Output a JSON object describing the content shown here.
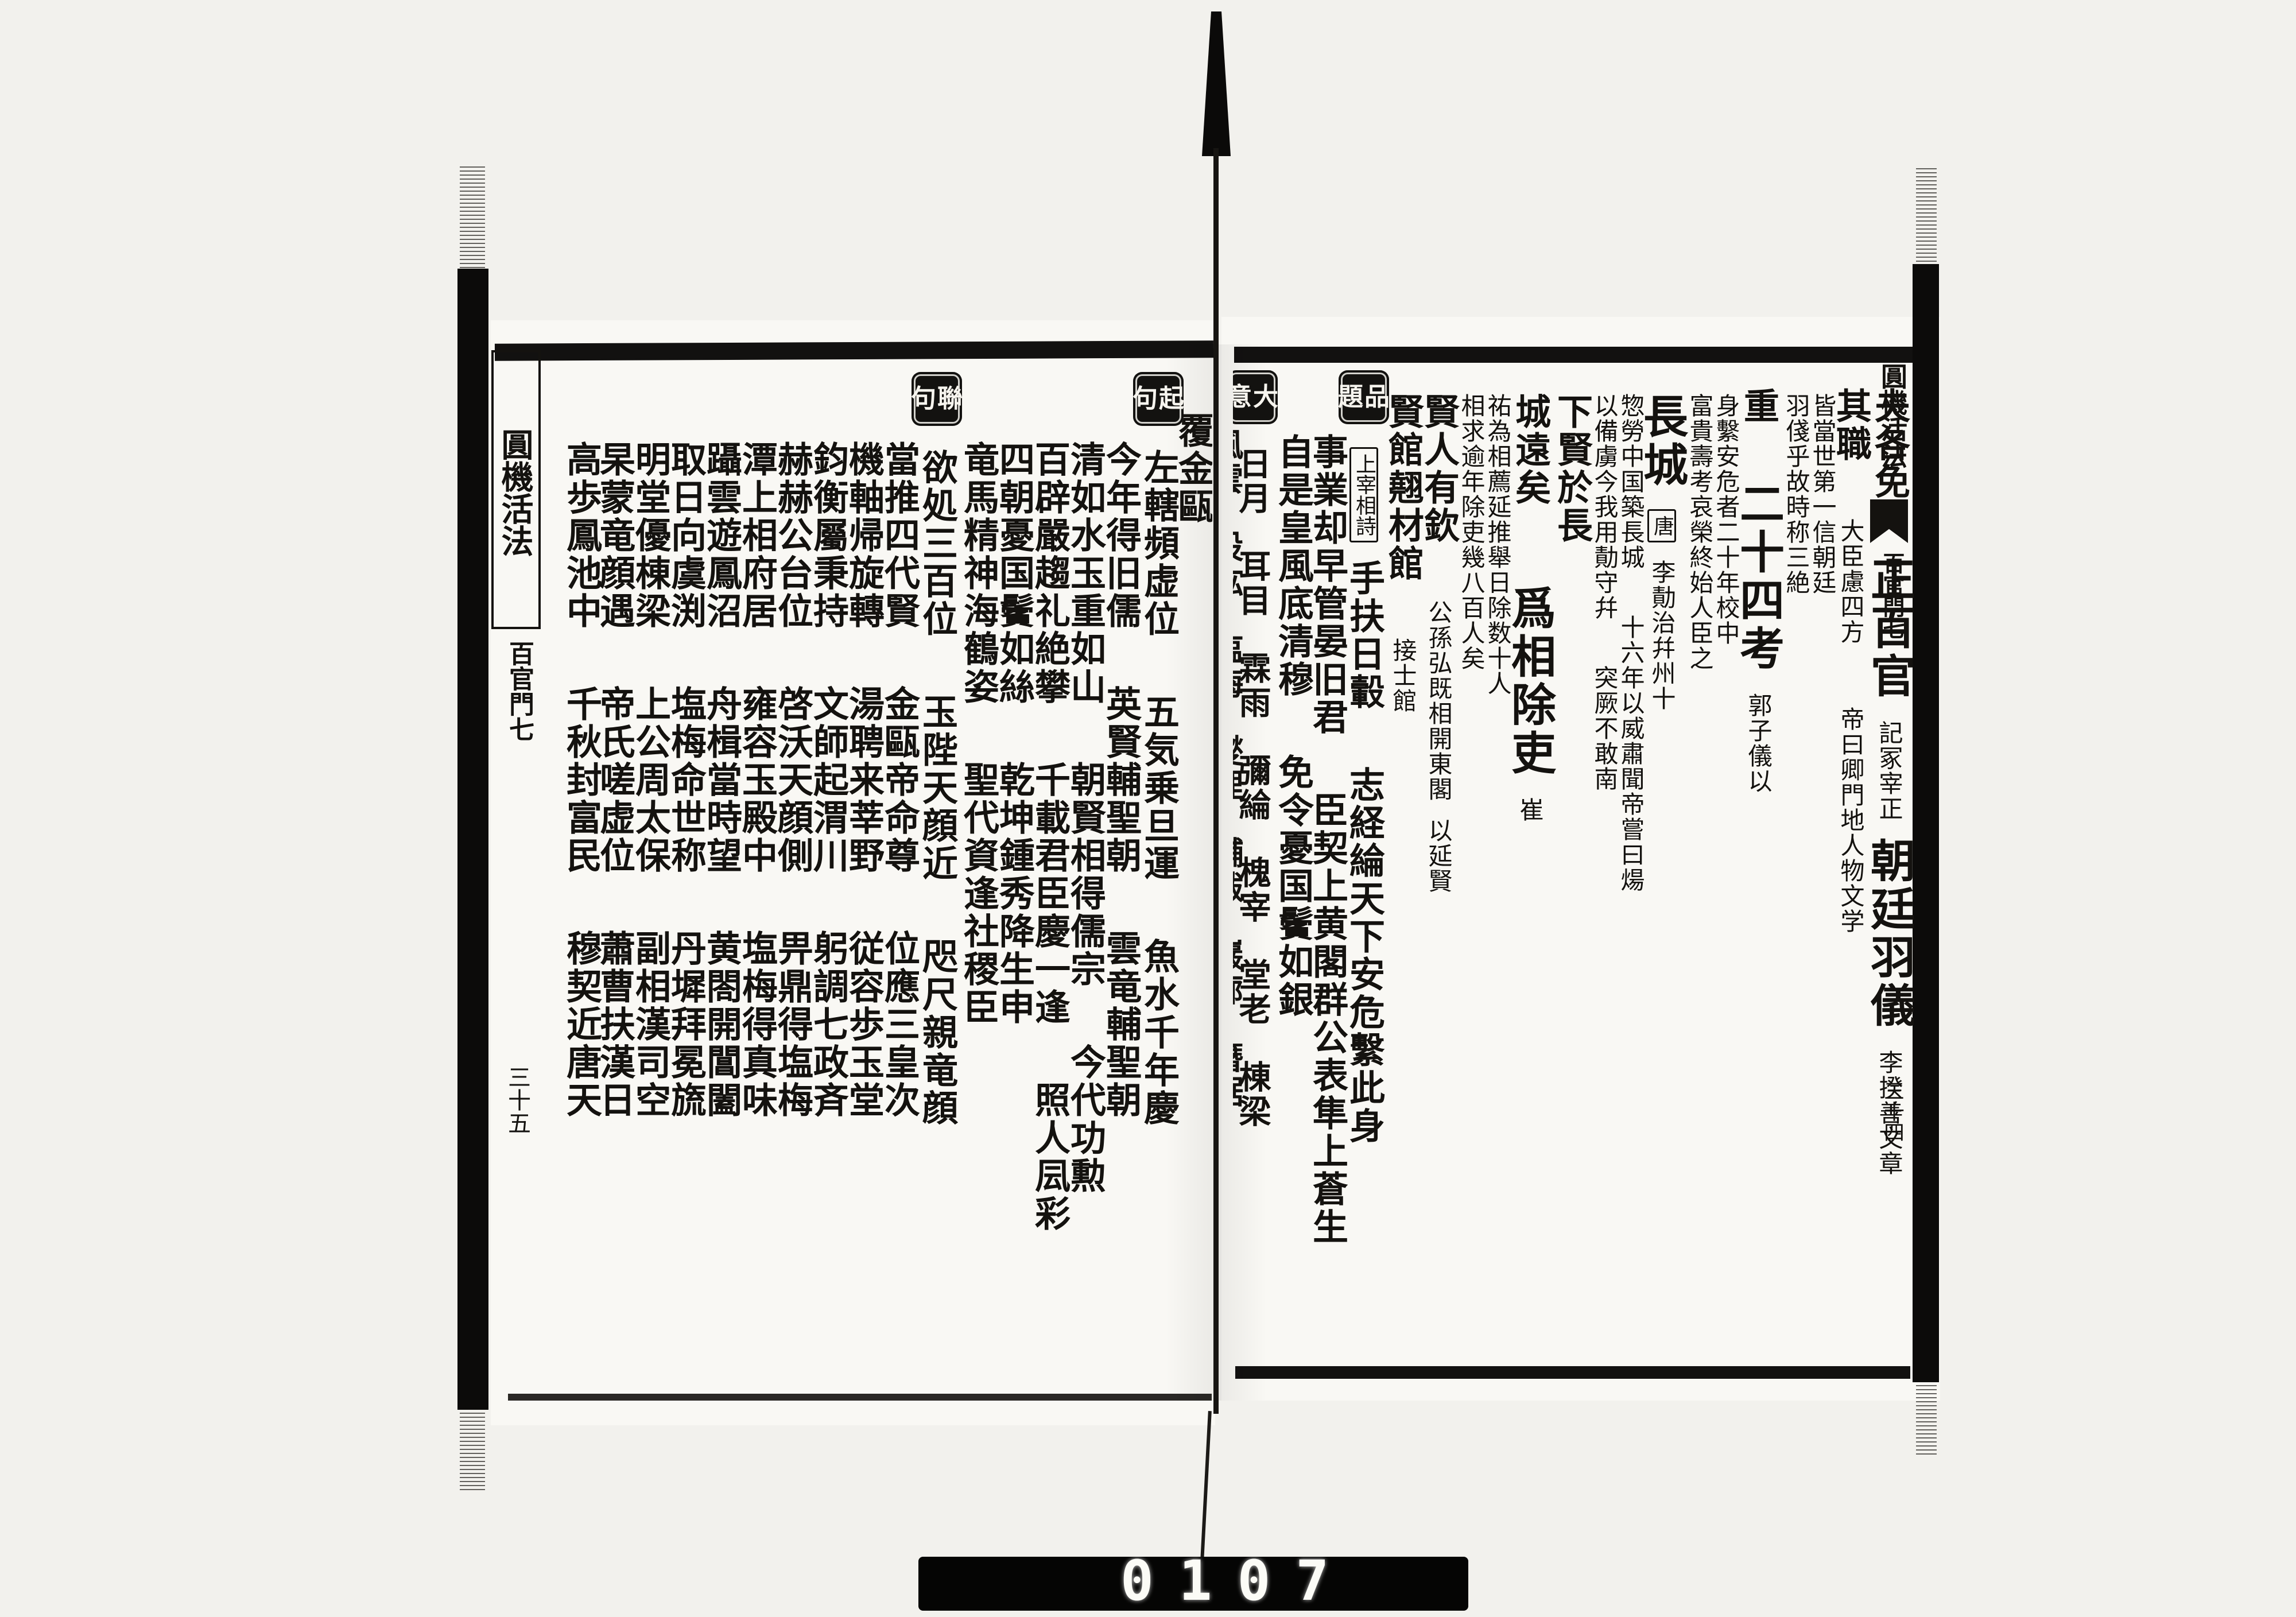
{
  "meta": {
    "colors": {
      "ink": "#14120f",
      "paper": "#f9f8f4",
      "background": "#f2f1ed",
      "label_box": "#131210",
      "counter_strip": "#050504",
      "counter_digits": "#fbfbf6"
    }
  },
  "edges": {
    "left": {
      "title": "圓機活法",
      "section": "百官門七",
      "page_no": "三十五"
    },
    "right": {
      "title": "圓機活法",
      "section": "百官門七",
      "page_no": "三十四"
    }
  },
  "counter": {
    "digits": "0107"
  },
  "right_page": {
    "columns": [
      {
        "w": 76,
        "segments": [
          {
            "kind": "gap",
            "h": 30
          },
          {
            "kind": "md",
            "text": "夫各免"
          },
          {
            "kind": "xl",
            "text": "正百官"
          },
          {
            "kind": "sm",
            "text": "記冢宰正"
          },
          {
            "kind": "xl",
            "text": "朝廷羽儀"
          },
          {
            "kind": "sm",
            "text": "李揆善文章"
          }
        ]
      },
      {
        "w": 60,
        "segments": [
          {
            "kind": "gap",
            "h": 30
          },
          {
            "kind": "md",
            "text": "其職"
          },
          {
            "kind": "sm",
            "text": "大臣慮四方"
          },
          {
            "kind": "gap",
            "h": 80
          },
          {
            "kind": "sm",
            "text": "帝曰卿門地人物文学"
          }
        ]
      },
      {
        "w": 46,
        "segments": [
          {
            "kind": "gap",
            "h": 40
          },
          {
            "kind": "sm",
            "text": "皆當世第一信朝廷"
          }
        ]
      },
      {
        "w": 46,
        "segments": [
          {
            "kind": "gap",
            "h": 40
          },
          {
            "kind": "sm",
            "text": "羽俴乎故時称三絶"
          }
        ]
      },
      {
        "w": 76,
        "segments": [
          {
            "kind": "gap",
            "h": 30
          },
          {
            "kind": "md",
            "text": "重"
          },
          {
            "kind": "xl",
            "text": "二十四考"
          },
          {
            "kind": "sm",
            "text": "郭子儀以"
          }
        ]
      },
      {
        "w": 46,
        "segments": [
          {
            "kind": "gap",
            "h": 40
          },
          {
            "kind": "sm",
            "text": "身繫安危者二十年校中"
          }
        ]
      },
      {
        "w": 46,
        "segments": [
          {
            "kind": "gap",
            "h": 40
          },
          {
            "kind": "sm",
            "text": "富貴壽考哀榮終始人臣之"
          }
        ]
      },
      {
        "w": 74,
        "segments": [
          {
            "kind": "gap",
            "h": 40
          },
          {
            "kind": "xl",
            "text": "長城"
          },
          {
            "kind": "tag",
            "text": "唐"
          },
          {
            "kind": "sm",
            "text": "李勣治幷州十"
          }
        ]
      },
      {
        "w": 46,
        "segments": [
          {
            "kind": "gap",
            "h": 40
          },
          {
            "kind": "sm",
            "text": "惣勞中国築長城"
          },
          {
            "kind": "gap",
            "h": 50
          },
          {
            "kind": "sm",
            "text": "十六年以威肅聞帝嘗曰煬"
          }
        ]
      },
      {
        "w": 46,
        "segments": [
          {
            "kind": "gap",
            "h": 40
          },
          {
            "kind": "sm",
            "text": "以備虜今我用勣守幷"
          },
          {
            "kind": "gap",
            "h": 50
          },
          {
            "kind": "sm",
            "text": "突厥不敢南"
          }
        ]
      },
      {
        "w": 64,
        "segments": [
          {
            "kind": "gap",
            "h": 40
          },
          {
            "kind": "md",
            "text": "下賢於長"
          }
        ]
      },
      {
        "w": 76,
        "segments": [
          {
            "kind": "gap",
            "h": 40
          },
          {
            "kind": "md",
            "text": "城遠矣"
          },
          {
            "kind": "gap",
            "h": 40
          },
          {
            "kind": "xl",
            "text": "爲相除吏"
          },
          {
            "kind": "sm",
            "text": "崔"
          }
        ]
      },
      {
        "w": 46,
        "segments": [
          {
            "kind": "gap",
            "h": 40
          },
          {
            "kind": "sm",
            "text": "祐為相薦延推舉日除数十人"
          }
        ]
      },
      {
        "w": 46,
        "segments": [
          {
            "kind": "gap",
            "h": 40
          },
          {
            "kind": "sm",
            "text": "相求逾年除吏幾八百人矣"
          }
        ]
      },
      {
        "w": 62,
        "segments": [
          {
            "kind": "gap",
            "h": 40
          },
          {
            "kind": "md",
            "text": "賢人有欽"
          },
          {
            "kind": "sm",
            "text": "公孫弘既相開東閣"
          },
          {
            "kind": "sm",
            "text": "以延賢"
          }
        ]
      },
      {
        "w": 58,
        "segments": [
          {
            "kind": "gap",
            "h": 40
          },
          {
            "kind": "md",
            "text": "賢館翹材館"
          },
          {
            "kind": "sm",
            "text": "接士館"
          }
        ]
      },
      {
        "w": 74,
        "segments": [
          {
            "kind": "box",
            "text": "品題"
          },
          {
            "kind": "tag",
            "text": "上宰相詩"
          },
          {
            "kind": "md",
            "text": "手扶日轂"
          },
          {
            "kind": "md",
            "text": "志経綸天下安危繫此身"
          }
        ]
      },
      {
        "w": 60,
        "segments": [
          {
            "kind": "gap",
            "h": 110
          },
          {
            "kind": "md",
            "text": "事業却早管晏旧君"
          },
          {
            "kind": "md",
            "text": "臣契上黄閣群公表隼上蒼生"
          }
        ]
      },
      {
        "w": 60,
        "segments": [
          {
            "kind": "gap",
            "h": 110
          },
          {
            "kind": "md",
            "text": "自是皇風底清穆"
          },
          {
            "kind": "md",
            "text": "免令憂国鬢如銀"
          }
        ]
      },
      {
        "w": 62,
        "segments": [
          {
            "kind": "box",
            "text": "大意"
          },
          {
            "kind": "word",
            "text": "日月"
          },
          {
            "kind": "word",
            "text": "耳目"
          },
          {
            "kind": "word",
            "text": "霖雨"
          },
          {
            "kind": "word",
            "text": "彌綸"
          },
          {
            "kind": "word",
            "text": "槐宰"
          },
          {
            "kind": "word",
            "text": "堂老"
          },
          {
            "kind": "word",
            "text": "棟梁"
          }
        ]
      },
      {
        "w": 50,
        "segments": [
          {
            "kind": "gap",
            "h": 100
          },
          {
            "kind": "word",
            "text": "風雲"
          },
          {
            "kind": "word",
            "text": "股肱"
          },
          {
            "kind": "word",
            "text": "塩梅"
          },
          {
            "kind": "word",
            "text": "燮理"
          },
          {
            "kind": "word",
            "text": "黼黻"
          },
          {
            "kind": "word",
            "text": "巖廊"
          },
          {
            "kind": "word",
            "text": "簪裾"
          }
        ]
      }
    ]
  },
  "left_page": {
    "columns": [
      {
        "w": 50,
        "segments": [
          {
            "kind": "gap",
            "h": 70
          },
          {
            "kind": "md",
            "text": "覆金甌"
          }
        ]
      },
      {
        "w": 76,
        "segments": [
          {
            "kind": "box",
            "text": "起句"
          },
          {
            "kind": "md",
            "text": "左轄頻虚位"
          },
          {
            "kind": "md",
            "text": "五気乗旦運"
          },
          {
            "kind": "md",
            "text": "魚水千年慶"
          }
        ]
      },
      {
        "w": 62,
        "segments": [
          {
            "kind": "gap",
            "h": 120
          },
          {
            "kind": "md",
            "text": "今年得旧儒"
          },
          {
            "kind": "md",
            "text": "英賢輔聖朝"
          },
          {
            "kind": "md",
            "text": "雲竜輔聖朝"
          }
        ]
      },
      {
        "w": 62,
        "segments": [
          {
            "kind": "gap",
            "h": 120
          },
          {
            "kind": "md",
            "text": "清如水玉重如山"
          },
          {
            "kind": "md",
            "text": "朝賢相得儒宗"
          },
          {
            "kind": "md",
            "text": "今代功勲"
          }
        ]
      },
      {
        "w": 62,
        "segments": [
          {
            "kind": "gap",
            "h": 120
          },
          {
            "kind": "md",
            "text": "百辟嚴趨礼絶攀"
          },
          {
            "kind": "md",
            "text": "千載君臣慶一逢"
          },
          {
            "kind": "md",
            "text": "照人凨彩"
          }
        ]
      },
      {
        "w": 62,
        "segments": [
          {
            "kind": "gap",
            "h": 120
          },
          {
            "kind": "md",
            "text": "四朝憂国鬢如絲"
          },
          {
            "kind": "md",
            "text": "乾坤鍾秀降生申"
          }
        ]
      },
      {
        "w": 62,
        "segments": [
          {
            "kind": "gap",
            "h": 120
          },
          {
            "kind": "md",
            "text": "竜馬精神海鶴姿"
          },
          {
            "kind": "md",
            "text": "聖代資逢社稷臣"
          }
        ]
      },
      {
        "w": 76,
        "segments": [
          {
            "kind": "box",
            "text": "聯句"
          },
          {
            "kind": "md",
            "text": "欲処三百位"
          },
          {
            "kind": "md",
            "text": "玉陛天顔近"
          },
          {
            "kind": "md",
            "text": "咫尺親竜顔"
          }
        ]
      },
      {
        "w": 62,
        "segments": [
          {
            "kind": "gap",
            "h": 120
          },
          {
            "kind": "md",
            "text": "當推四代賢"
          },
          {
            "kind": "md",
            "text": "金甌帝命尊"
          },
          {
            "kind": "md",
            "text": "位應三皇次"
          }
        ]
      },
      {
        "w": 62,
        "segments": [
          {
            "kind": "gap",
            "h": 120
          },
          {
            "kind": "md",
            "text": "機軸帰旋轉"
          },
          {
            "kind": "md",
            "text": "湯聘来莘野"
          },
          {
            "kind": "md",
            "text": "従容歩玉堂"
          }
        ]
      },
      {
        "w": 62,
        "segments": [
          {
            "kind": "gap",
            "h": 120
          },
          {
            "kind": "md",
            "text": "鈞衡屬秉持"
          },
          {
            "kind": "md",
            "text": "文師起渭川"
          },
          {
            "kind": "md",
            "text": "躬調七政斉"
          }
        ]
      },
      {
        "w": 62,
        "segments": [
          {
            "kind": "gap",
            "h": 120
          },
          {
            "kind": "md",
            "text": "赫赫公台位"
          },
          {
            "kind": "md",
            "text": "啓沃天顔側"
          },
          {
            "kind": "md",
            "text": "畀鼎得塩梅"
          }
        ]
      },
      {
        "w": 62,
        "segments": [
          {
            "kind": "gap",
            "h": 120
          },
          {
            "kind": "md",
            "text": "潭上相府居"
          },
          {
            "kind": "md",
            "text": "雍容玉殿中"
          },
          {
            "kind": "md",
            "text": "塩梅得真味"
          }
        ]
      },
      {
        "w": 62,
        "segments": [
          {
            "kind": "gap",
            "h": 120
          },
          {
            "kind": "md",
            "text": "躡雲遊鳳沼"
          },
          {
            "kind": "md",
            "text": "舟楫當時望"
          },
          {
            "kind": "md",
            "text": "黄閤開閶闔"
          }
        ]
      },
      {
        "w": 62,
        "segments": [
          {
            "kind": "gap",
            "h": 120
          },
          {
            "kind": "md",
            "text": "取日向虞渕"
          },
          {
            "kind": "md",
            "text": "塩梅命世称"
          },
          {
            "kind": "md",
            "text": "丹墀拜冕旒"
          }
        ]
      },
      {
        "w": 62,
        "segments": [
          {
            "kind": "gap",
            "h": 120
          },
          {
            "kind": "md",
            "text": "明堂優棟梁"
          },
          {
            "kind": "md",
            "text": "上公周太保"
          },
          {
            "kind": "md",
            "text": "副相漢司空"
          }
        ]
      },
      {
        "w": 58,
        "segments": [
          {
            "kind": "gap",
            "h": 120
          },
          {
            "kind": "md",
            "text": "杲蒙竜顔遇"
          },
          {
            "kind": "md",
            "text": "帝氏嗟虚位"
          },
          {
            "kind": "md",
            "text": "蕭曹扶漢日"
          }
        ]
      },
      {
        "w": 58,
        "segments": [
          {
            "kind": "gap",
            "h": 120
          },
          {
            "kind": "md",
            "text": "高歩鳳池中"
          },
          {
            "kind": "md",
            "text": "千秋封富民"
          },
          {
            "kind": "md",
            "text": "穆契近唐天"
          }
        ]
      }
    ]
  }
}
